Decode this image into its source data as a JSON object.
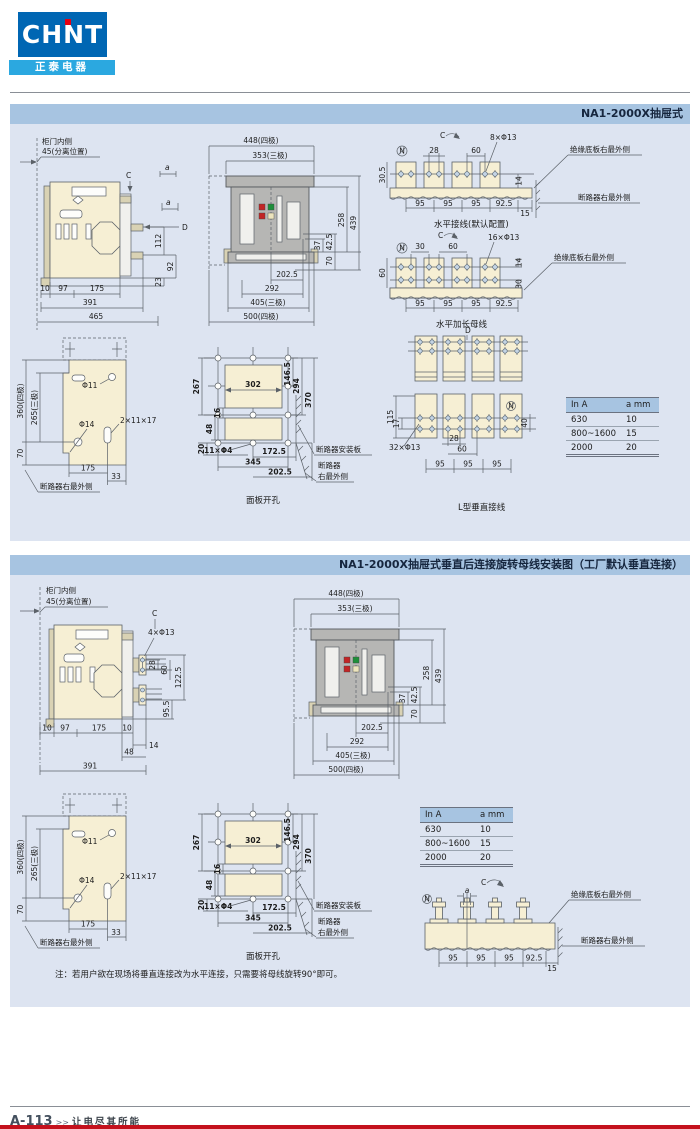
{
  "brand": {
    "logo": "CHNT",
    "name": "正泰电器"
  },
  "panel1": {
    "title": "NA1-2000X抽屉式",
    "side": {
      "door": "柜门内侧",
      "sep": "45(分离位置)",
      "a1": "a",
      "c": "C",
      "a2": "a",
      "d": "D",
      "v112": "112",
      "v92": "92",
      "v23": "23",
      "b10": "10",
      "b97": "97",
      "b175": "175",
      "b391": "391",
      "b465": "465"
    },
    "horiz": {
      "c": "C",
      "n": "N",
      "d28": "28",
      "d60": "60",
      "holes": "8×Φ13",
      "v305": "30.5",
      "v14": "14",
      "p1": "95",
      "p2": "95",
      "p3": "95",
      "p4": "92.5",
      "p5": "15",
      "caption": "水平接线(默认配置)",
      "callout_ins": "绝缘底板右最外侧",
      "callout_brk": "断路器右最外侧"
    },
    "ext": {
      "c": "C",
      "n": "N",
      "d30": "30",
      "d60": "60",
      "holes": "16×Φ13",
      "v14": "14",
      "v60": "60",
      "v30": "30",
      "p1": "95",
      "p2": "95",
      "p3": "95",
      "p4": "92.5",
      "caption": "水平加长母线",
      "callout_ins": "绝缘底板右最外侧"
    },
    "ltype": {
      "d": "D",
      "n": "N",
      "v115": "115",
      "v17": "17",
      "holes": "32×Φ13",
      "d28": "28",
      "d60": "60",
      "v40": "40",
      "p1": "95",
      "p2": "95",
      "p3": "95",
      "caption": "L型垂直接线"
    }
  },
  "panel2": {
    "title": "NA1-2000X抽屉式垂直后连接旋转母线安装图（工厂默认垂直连接）",
    "side": {
      "door": "柜门内侧",
      "sep": "45(分离位置)",
      "c": "C",
      "holes": "4×Φ13",
      "v28": "28",
      "v60": "60",
      "v1225": "122.5",
      "v955": "95.5",
      "b10a": "10",
      "b97": "97",
      "b175": "175",
      "b10b": "10",
      "b14": "14",
      "b48": "48",
      "b391": "391"
    },
    "vert": {
      "c": "C",
      "n": "N",
      "a": "a",
      "p1": "95",
      "p2": "95",
      "p3": "95",
      "p4": "92.5",
      "p5": "15",
      "callout_ins": "绝缘底板右最外侧",
      "callout_brk": "断路器右最外侧"
    },
    "note": "注：若用户欲在现场将垂直连接改为水平连接，只需要将母线旋转90°即可。"
  },
  "front": {
    "t448": "448(四极)",
    "t353": "353(三极)",
    "v258": "258",
    "v439": "439",
    "v37": "37",
    "v425": "42.5",
    "v70": "70",
    "b2025": "202.5",
    "b292": "292",
    "b405": "405(三极)",
    "b500": "500(四极)"
  },
  "plate": {
    "v360": "360(四极)",
    "v265": "265(三极)",
    "v70": "70",
    "h11": "Φ11",
    "h14": "Φ14",
    "slot": "2×11×17",
    "b175": "175",
    "b33": "33",
    "callout": "断路器右最外侧"
  },
  "cutout": {
    "v267": "267",
    "v16": "16",
    "v48": "48",
    "v20": "20",
    "d302": "302",
    "v1465": "146.5",
    "v294": "294",
    "v370": "370",
    "holes": "11×Φ4",
    "b1725": "172.5",
    "b345": "345",
    "b2025": "202.5",
    "callout_plate": "断路器安装板",
    "callout_brk1": "断路器",
    "callout_brk2": "右最外侧",
    "caption": "面板开孔"
  },
  "spec_table": {
    "headers": [
      "In A",
      "a mm"
    ],
    "rows": [
      [
        "630",
        "10"
      ],
      [
        "800~1600",
        "15"
      ],
      [
        "2000",
        "20"
      ]
    ]
  },
  "footer": {
    "page": "A-113",
    "arrows": ">>",
    "slogan": "让电尽其所能"
  }
}
